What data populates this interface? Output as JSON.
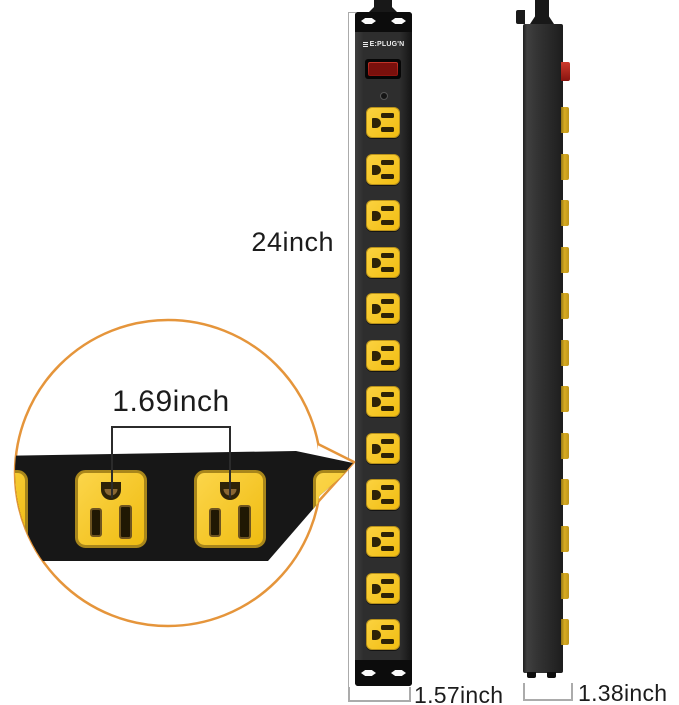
{
  "product": {
    "brand": "E:PLUG'N",
    "front_view": {
      "outlet_count": 12
    },
    "side_view": {
      "outlet_edge_count": 12
    }
  },
  "dimensions": {
    "height": "24inch",
    "front_width": "1.57inch",
    "side_depth": "1.38inch",
    "outlet_center_spacing": "1.69inch"
  },
  "colors": {
    "accent_orange": "#E5953B",
    "outlet_yellow": "#F6C41C",
    "strip_black": "#171717",
    "switch_red": "#C0281C",
    "keyhole_white": "#FAFAFA"
  }
}
